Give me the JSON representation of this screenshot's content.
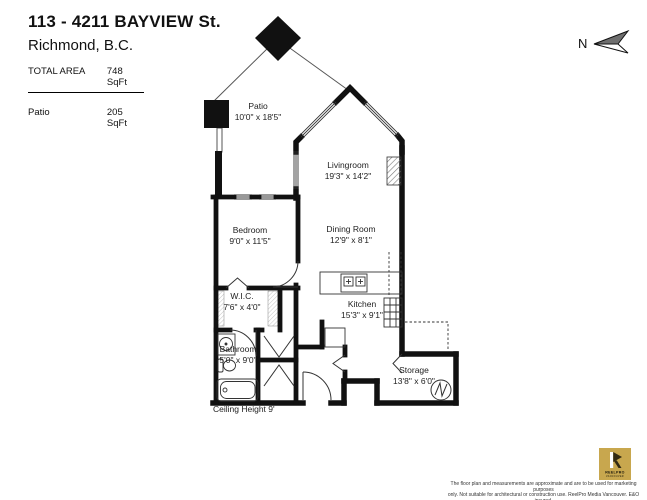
{
  "header": {
    "address_line1": "113 - 4211 BAYVIEW St.",
    "address_line2": "Richmond, B.C.",
    "total_area_label": "TOTAL AREA",
    "total_area_value": "748 SqFt",
    "patio_area_label": "Patio",
    "patio_area_value": "205 SqFt"
  },
  "compass": {
    "label": "N"
  },
  "floorplan": {
    "rooms": [
      {
        "id": "patio",
        "name": "Patio",
        "dims": "10'0\" x 18'5\""
      },
      {
        "id": "livingroom",
        "name": "Livingroom",
        "dims": "19'3\" x 14'2\""
      },
      {
        "id": "bedroom",
        "name": "Bedroom",
        "dims": "9'0\" x 11'5\""
      },
      {
        "id": "dining-room",
        "name": "Dining Room",
        "dims": "12'9\" x 8'1\""
      },
      {
        "id": "wic",
        "name": "W.I.C.",
        "dims": "7'6\" x 4'0\""
      },
      {
        "id": "kitchen",
        "name": "Kitchen",
        "dims": "15'3\" x 9'1\""
      },
      {
        "id": "bathroom",
        "name": "Bathroom",
        "dims": "5'0\" x 9'0\""
      },
      {
        "id": "storage",
        "name": "Storage",
        "dims": "13'8\" x 6'0\""
      }
    ],
    "ceiling_note": "Ceiling Height  9'"
  },
  "footer": {
    "logo": {
      "brand": "REELPRO",
      "region": "VANCOUVER",
      "color": "#c8a74e"
    },
    "disclaimer_line1": "The floor plan and measurements are approximate and are to be used for marketing purposes",
    "disclaimer_line2": "only. Not suitable for architectural or construction use. ReelPro Media Vancouver. E&O insured."
  }
}
